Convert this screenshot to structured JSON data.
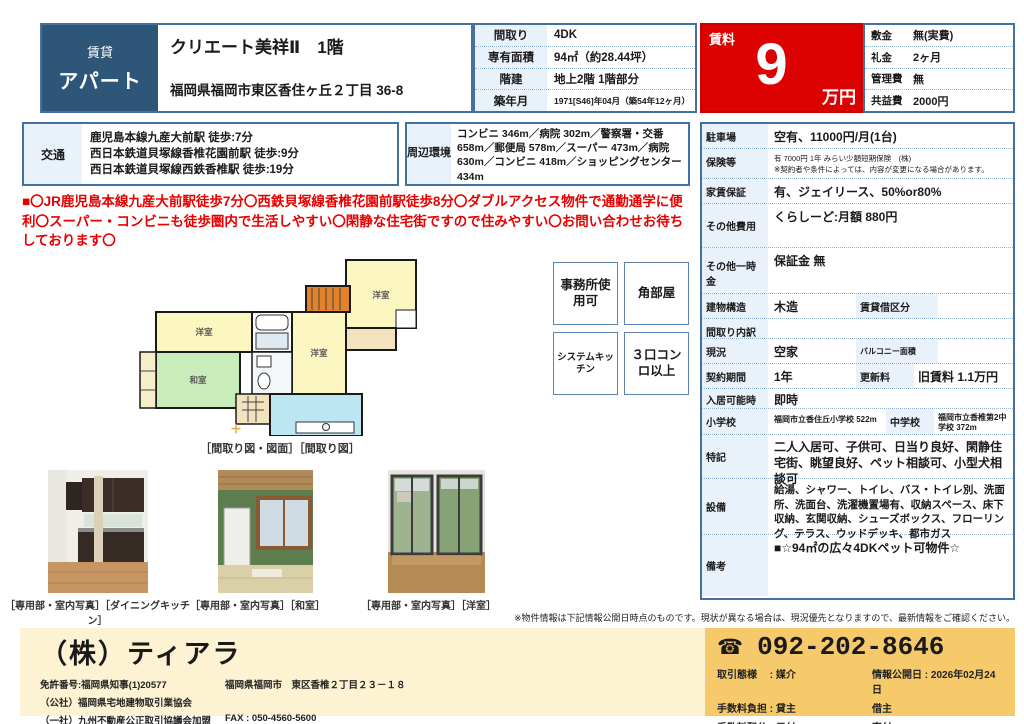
{
  "header": {
    "category_top": "賃貸",
    "category_main": "アパート",
    "title": "クリエート美祥Ⅱ　1階",
    "address": "福岡県福岡市東区香住ヶ丘２丁目 36-8",
    "specs": [
      {
        "label": "間取り",
        "value": "4DK"
      },
      {
        "label": "専有面積",
        "value": "94㎡（約28.44坪）"
      },
      {
        "label": "階建",
        "value": "地上2階 1階部分"
      },
      {
        "label": "築年月",
        "value": "1971[S46]年04月（築54年12ヶ月）"
      }
    ],
    "rent": {
      "label": "賃料",
      "amount": "9",
      "unit": "万円"
    },
    "fees": [
      {
        "label": "敷金",
        "value": "無(実費)"
      },
      {
        "label": "礼金",
        "value": "2ヶ月"
      },
      {
        "label": "管理費",
        "value": "無"
      },
      {
        "label": "共益費",
        "value": "2000円"
      }
    ]
  },
  "access": {
    "label": "交通",
    "lines": [
      "鹿児島本線九産大前駅 徒歩:7分",
      "西日本鉄道貝塚線香椎花園前駅 徒歩:9分",
      "西日本鉄道貝塚線西鉄香椎駅 徒歩:19分"
    ]
  },
  "surroundings": {
    "label": "周辺環境",
    "text": "コンビニ 346m／病院 302m／警察署・交番 658m／郵便局 578m／スーパー 473m／病院 630m／コンビニ 418m／ショッピングセンター 434m"
  },
  "pr_text": "■〇JR鹿児島本線九産大前駅徒歩7分〇西鉄貝塚線香椎花園前駅徒歩8分〇ダブルアクセス物件で通勤通学に便利〇スーパー・コンビニも徒歩圏内で生活しやすい〇閑静な住宅街ですので住みやすい〇お問い合わせお待ちしております〇",
  "floorplan": {
    "caption": "［間取り図・図面］［間取り図］",
    "rooms": [
      "洋室",
      "洋室",
      "洋室",
      "和室"
    ],
    "plus_mark": "＋"
  },
  "badges": [
    {
      "label": "事務所使用可"
    },
    {
      "label": "角部屋"
    },
    {
      "label": "システムキッチン"
    },
    {
      "label": "３口コンロ以上"
    }
  ],
  "details": {
    "parking": {
      "label": "駐車場",
      "value": "空有、11000円/月(1台)"
    },
    "insurance": {
      "label": "保険等",
      "line1": "有 7000円 1年 みらい少額短期保険　(株)",
      "line2": "※契約者や条件によっては、内容が変更になる場合があります。"
    },
    "guarantee": {
      "label": "家賃保証",
      "value": "有、ジェイリース、50%or80%"
    },
    "other_fees": {
      "label": "その他費用",
      "value": "くらしーど:月額 880円"
    },
    "other_onetime": {
      "label": "その他一時金",
      "value": "保証金 無"
    },
    "structure": {
      "label": "建物構造",
      "value": "木造",
      "sub_label": "賃貸借区分",
      "sub_value": ""
    },
    "layout_detail": {
      "label": "間取り内訳",
      "value": ""
    },
    "status": {
      "label": "現況",
      "value": "空家",
      "sub_label": "バルコニー面積",
      "sub_value": ""
    },
    "contract": {
      "label": "契約期間",
      "value": "1年",
      "sub_label": "更新料",
      "sub_value": "旧賃料 1.1万円"
    },
    "move_in": {
      "label": "入居可能時期",
      "value": "即時"
    },
    "school": {
      "label": "小学校",
      "value": "福岡市立香住丘小学校 522m",
      "sub_label": "中学校",
      "sub_value": "福岡市立香椎第2中学校 372m"
    },
    "notes": {
      "label": "特記",
      "value": "二人入居可、子供可、日当り良好、閑静住宅街、眺望良好、ペット相談可、小型犬相談可"
    },
    "equipment": {
      "label": "設備",
      "value": "給湯、シャワー、トイレ、バス・トイレ別、洗面所、洗面台、洗濯機置場有、収納スペース、床下収納、玄関収納、シューズボックス、フローリング、テラス、ウッドデッキ、都市ガス"
    },
    "remarks": {
      "label": "備考",
      "value": "■☆94㎡の広々4DKペット可物件☆"
    }
  },
  "photos": [
    {
      "caption": "［専用部・室内写真］［ダイニングキッチン］"
    },
    {
      "caption": "［専用部・室内写真］［和室］"
    },
    {
      "caption": "［専用部・室内写真］［洋室］"
    }
  ],
  "disclaimer": "※物件情報は下記情報公開日時点のものです。現状が異なる場合は、現況優先となりますので、最新情報をご確認ください。",
  "footer": {
    "company": "（株）ティアラ",
    "license": "免許番号:福岡県知事(1)20577",
    "association1": "（公社）福岡県宅地建物取引業協会",
    "association2": "（一社）九州不動産公正取引協議会加盟",
    "office_address": "福岡県福岡市　東区香椎２丁目２３－１８",
    "fax": "FAX : 050-4560-5600",
    "phone_icon": "☎",
    "phone": "092-202-8646",
    "info_rows": [
      {
        "left": "取引態様　 : 媒介",
        "right": "情報公開日 : 2026年02月24日"
      },
      {
        "left": "手数料負担 : 貸主",
        "right": "借主"
      },
      {
        "left": "手数料配分 : 元付",
        "right": "客付"
      }
    ]
  },
  "colors": {
    "category_bg": "#2d5678",
    "rent_bg": "#dd0202",
    "pr_text": "#e60000",
    "label_cell_bg": "#e9f1fa",
    "border_blue": "#44719f",
    "footer_left_bg": "#fdf2d2",
    "footer_right_bg": "#f6c96a"
  }
}
